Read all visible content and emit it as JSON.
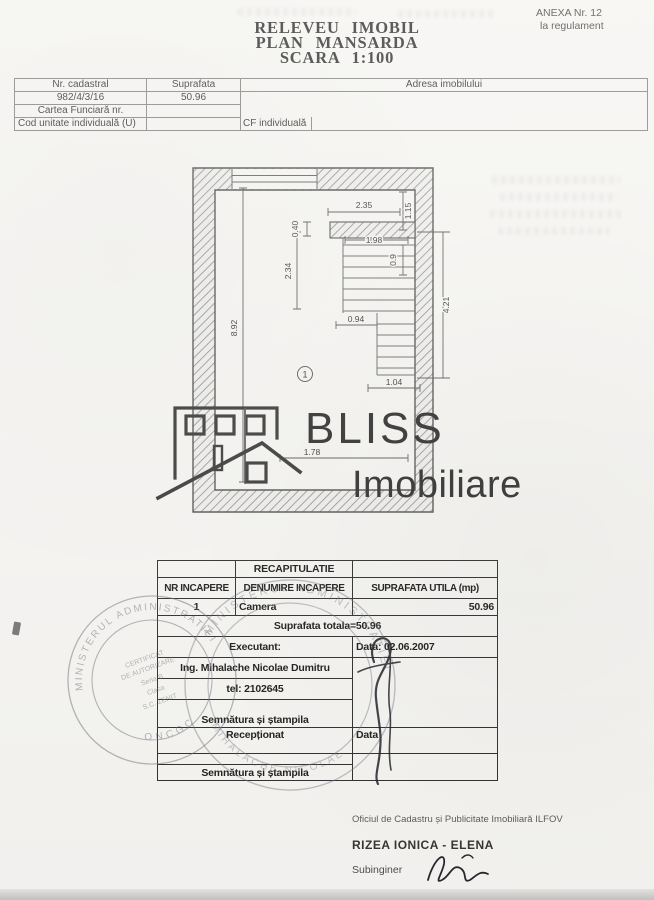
{
  "document": {
    "anexa": {
      "line1": "ANEXA Nr. 12",
      "line2": "la regulament"
    },
    "title": {
      "line1": "RELEVEU IMOBIL",
      "line2": "PLAN MANSARDA",
      "line3": "SCARA 1:100"
    }
  },
  "info_table": {
    "headers": {
      "nr_cadastral": "Nr. cadastral",
      "suprafata": "Suprafata",
      "adresa": "Adresa imobilului"
    },
    "values": {
      "nr_cadastral": "982/4/3/16",
      "suprafata": "50.96"
    },
    "labels": {
      "cartea_funciara": "Cartea Funciară nr.",
      "cod_unitate": "Cod unitate individuală (U)",
      "cf_individuala": "CF individuală"
    }
  },
  "plan": {
    "room_number": "1",
    "dims": {
      "partition_width": "2.35",
      "right_top": "1.15",
      "wall_offset": "0.40",
      "stair_width": "1.98",
      "stair_top": "0.9",
      "left_mid": "2.34",
      "landing": "0.94",
      "stair_run": "4.21",
      "room_length": "8.92",
      "stair_exit": "1.04",
      "room_width": "1.78"
    }
  },
  "logo": {
    "word1": "BLISS",
    "word2": "Imobiliare"
  },
  "recap_table": {
    "title": "RECAPITULATIE",
    "headers": {
      "nr": "NR INCAPERE",
      "denumire": "DENUMIRE INCAPERE",
      "suprafata": "SUPRAFATA UTILA (mp)"
    },
    "rows": [
      {
        "nr": "1",
        "denumire": "Camera",
        "suprafata": "50.96"
      }
    ],
    "total": "Suprafata totala=50.96",
    "executant_label": "Executant:",
    "executant_data": "Data: 02.06.2007",
    "executant_name": "Ing. Mihalache Nicolae Dumitru",
    "executant_tel": "tel: 2102645",
    "semnatura1": "Semnătura și ștampila",
    "receptionat": "Recepționat",
    "receptionat_data": "Data",
    "semnatura2": "Semnătura și ștampila"
  },
  "stamps": {
    "stamp1": {
      "ring_top": "MINISTERUL ADMINISTRATIEI",
      "ring_bottom": "ONCGC",
      "line1": "CERTIFICAT",
      "line2": "DE AUTORIZARE",
      "line3": "Seria B",
      "line4": "Clasa",
      "line5": "S.C. ZENIT"
    },
    "stamp2": {
      "ring_top": "MINISTERUL ADMINISTRATIEI",
      "ring_bottom": "MIHALACHE NICOLAE"
    }
  },
  "footer": {
    "office": "Oficiul de Cadastru și Publicitate Imobiliară ILFOV",
    "name": "RIZEA IONICA - ELENA",
    "role": "Subinginer"
  },
  "colors": {
    "paper": "#f6f5f2",
    "ink": "#2e2e2e",
    "stamp": "#72727e"
  }
}
